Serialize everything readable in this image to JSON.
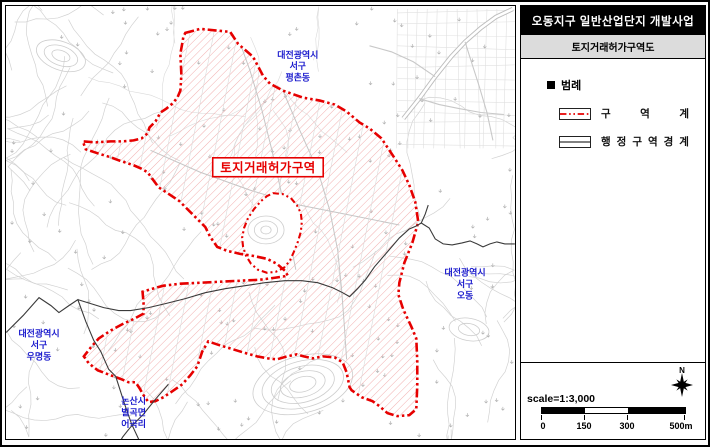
{
  "panel": {
    "title": "오동지구 일반산업단지 개발사업",
    "subtitle": "토지거래허가구역도",
    "legend_title": "범례",
    "legend": [
      {
        "label": "구역계",
        "symbol": "red-dashdot-line"
      },
      {
        "label": "행정구역경계",
        "symbol": "black-double-line"
      }
    ],
    "scale_text": "scale=1:3,000",
    "scale_ticks": [
      "0",
      "150",
      "300",
      "500m"
    ],
    "north_label": "N"
  },
  "map": {
    "zone_label": "토지거래허가구역",
    "area_labels": [
      {
        "lines": [
          "대전광역시",
          "서구",
          "평촌동"
        ],
        "x": 298,
        "y": 57
      },
      {
        "lines": [
          "대전광역시",
          "서구",
          "오동"
        ],
        "x": 466,
        "y": 276
      },
      {
        "lines": [
          "대전광역시",
          "서구",
          "우명동"
        ],
        "x": 38,
        "y": 337
      },
      {
        "lines": [
          "논산시",
          "벌곡면",
          "어곡리"
        ],
        "x": 133,
        "y": 405
      }
    ],
    "colors": {
      "boundary": "#e60000",
      "hatch": "#f2b0b0",
      "label_blue": "#1a1acd",
      "admin_line": "#3a3a3a",
      "contour": "#cdcdcd",
      "subtitle_bg": "#dcdcdc"
    },
    "zone_polygon": [
      185,
      32,
      200,
      28,
      230,
      31,
      238,
      43,
      253,
      56,
      263,
      75,
      270,
      83,
      283,
      90,
      303,
      97,
      320,
      100,
      335,
      104,
      347,
      111,
      360,
      122,
      370,
      128,
      382,
      138,
      394,
      156,
      403,
      170,
      410,
      185,
      416,
      202,
      419,
      222,
      413,
      243,
      405,
      263,
      400,
      283,
      399,
      295,
      404,
      310,
      412,
      327,
      417,
      339,
      418,
      362,
      418,
      386,
      417,
      410,
      410,
      416,
      398,
      417,
      388,
      414,
      380,
      407,
      373,
      402,
      362,
      398,
      352,
      391,
      350,
      388,
      347,
      373,
      343,
      363,
      335,
      358,
      323,
      357,
      313,
      359,
      304,
      357,
      297,
      355,
      287,
      357,
      277,
      360,
      268,
      359,
      257,
      357,
      243,
      353,
      230,
      349,
      217,
      345,
      208,
      342,
      202,
      352,
      197,
      367,
      190,
      376,
      182,
      385,
      172,
      392,
      163,
      398,
      155,
      402,
      148,
      403,
      143,
      396,
      139,
      389,
      135,
      383,
      128,
      383,
      121,
      380,
      110,
      376,
      97,
      371,
      88,
      364,
      83,
      357,
      90,
      348,
      98,
      339,
      110,
      331,
      123,
      324,
      134,
      319,
      143,
      314,
      143,
      303,
      142,
      292,
      152,
      289,
      163,
      286,
      180,
      284,
      200,
      283,
      220,
      282,
      240,
      281,
      260,
      280,
      275,
      278,
      288,
      276,
      285,
      271,
      277,
      264,
      267,
      259,
      253,
      256,
      240,
      254,
      227,
      251,
      217,
      247,
      210,
      237,
      205,
      227,
      195,
      217,
      185,
      207,
      179,
      201,
      167,
      193,
      158,
      187,
      147,
      172,
      140,
      168,
      133,
      165,
      118,
      160,
      110,
      157,
      97,
      153,
      85,
      149,
      82,
      141,
      95,
      142,
      110,
      141,
      122,
      141,
      133,
      140,
      141,
      138,
      147,
      133,
      149,
      127,
      155,
      121,
      160,
      112,
      166,
      108,
      172,
      103,
      177,
      97,
      180,
      90,
      181,
      74,
      180,
      53,
      182,
      42,
      183,
      36
    ],
    "exclusion_polygon": [
      273,
      193,
      283,
      194,
      291,
      198,
      297,
      205,
      301,
      213,
      302,
      222,
      301,
      232,
      298,
      242,
      294,
      252,
      290,
      261,
      284,
      268,
      276,
      272,
      267,
      273,
      258,
      270,
      251,
      264,
      246,
      256,
      243,
      247,
      242,
      238,
      244,
      228,
      248,
      218,
      254,
      209,
      261,
      201,
      267,
      196
    ],
    "admin_lines": [
      [
        5,
        333,
        22,
        316,
        38,
        298,
        50,
        306,
        58,
        313,
        68,
        306,
        77,
        300,
        85,
        322,
        93,
        341,
        100,
        352,
        108,
        370,
        115,
        377,
        124,
        405,
        131,
        425,
        138,
        440,
        141,
        447
      ],
      [
        77,
        300,
        90,
        304,
        103,
        308,
        118,
        311,
        130,
        311,
        148,
        308,
        165,
        304,
        185,
        299,
        205,
        293,
        225,
        289,
        245,
        286,
        265,
        283,
        285,
        281,
        302,
        281,
        318,
        283,
        333,
        288,
        343,
        293,
        350,
        297,
        358,
        289,
        366,
        280,
        375,
        267,
        388,
        252,
        400,
        238,
        410,
        229,
        417,
        226,
        422,
        223
      ],
      [
        422,
        223,
        430,
        228,
        436,
        239,
        444,
        244,
        453,
        245,
        463,
        243,
        471,
        241,
        478,
        244,
        484,
        247,
        491,
        244,
        498,
        242,
        506,
        244,
        516,
        244
      ],
      [
        422,
        223,
        426,
        214,
        429,
        205
      ],
      [
        168,
        385,
        155,
        400,
        143,
        415,
        130,
        428,
        122,
        438,
        117,
        447
      ]
    ],
    "roads_outside": [
      [
        404,
        118,
        420,
        98,
        436,
        76,
        452,
        56,
        466,
        41,
        482,
        27,
        497,
        16,
        514,
        8
      ]
    ],
    "roads_thin": [
      [
        466,
        41,
        472,
        60,
        480,
        85,
        488,
        112,
        494,
        140
      ],
      [
        420,
        98,
        440,
        104,
        460,
        108,
        482,
        112,
        505,
        114
      ],
      [
        436,
        76,
        414,
        61,
        392,
        51,
        370,
        45
      ]
    ],
    "roads_inside_zone": [
      [
        237,
        34,
        250,
        70,
        262,
        110,
        272,
        150,
        282,
        195,
        290,
        240,
        296,
        270
      ],
      [
        283,
        90,
        300,
        130,
        318,
        170,
        330,
        210,
        338,
        250,
        342,
        290,
        345,
        330,
        347,
        360
      ],
      [
        150,
        150,
        200,
        172,
        250,
        190,
        300,
        205,
        350,
        215,
        400,
        225
      ]
    ],
    "zone_label_box": {
      "x": 212.5,
      "y": 157.5,
      "w": 111,
      "h": 19,
      "cx": 268,
      "cy": 172
    }
  }
}
